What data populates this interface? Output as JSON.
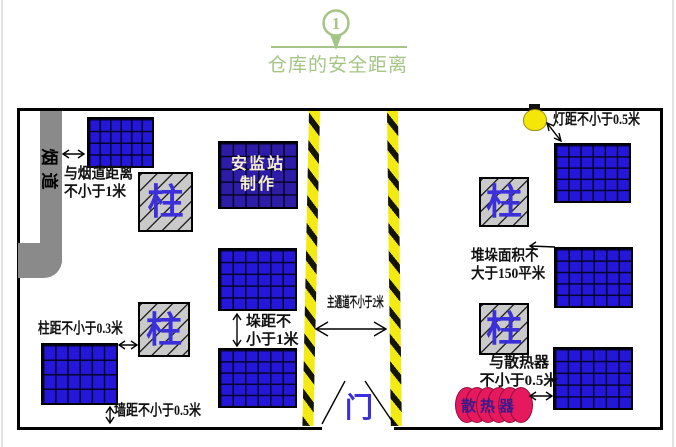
{
  "header": {
    "step_number": "1",
    "title": "仓库的安全距离"
  },
  "warehouse": {
    "flue_label": "烟道",
    "pillar_label": "柱",
    "door_label": "门",
    "maker_line1": "安监站",
    "maker_line2": "制作",
    "radiator_label": "散热器"
  },
  "annotations": {
    "flue_distance_line1": "与烟道距离",
    "flue_distance_line2": "不小于1米",
    "pillar_distance": "柱距不小于0.3米",
    "wall_distance": "墙距不小于0.5米",
    "stack_gap_line1": "垛距不",
    "stack_gap_line2": "小于1米",
    "main_aisle": "主通道不小于2米",
    "lamp_distance": "灯距不小于0.5米",
    "stack_area_line1": "堆垛面积不",
    "stack_area_line2": "大于150平米",
    "radiator_distance_line1": "与散热器",
    "radiator_distance_line2": "不小于0.5米"
  },
  "colors": {
    "accent_green": "#a4c585",
    "stack_blue": "#2417da",
    "maker_stack_blue": "#2c1ca8",
    "pillar_gray": "#cacaca",
    "flue_gray": "#8a8a8a",
    "hazard_yellow": "#f2ea10",
    "radiator_red": "#e6195e",
    "pillar_text_blue": "#3a2fd8"
  }
}
